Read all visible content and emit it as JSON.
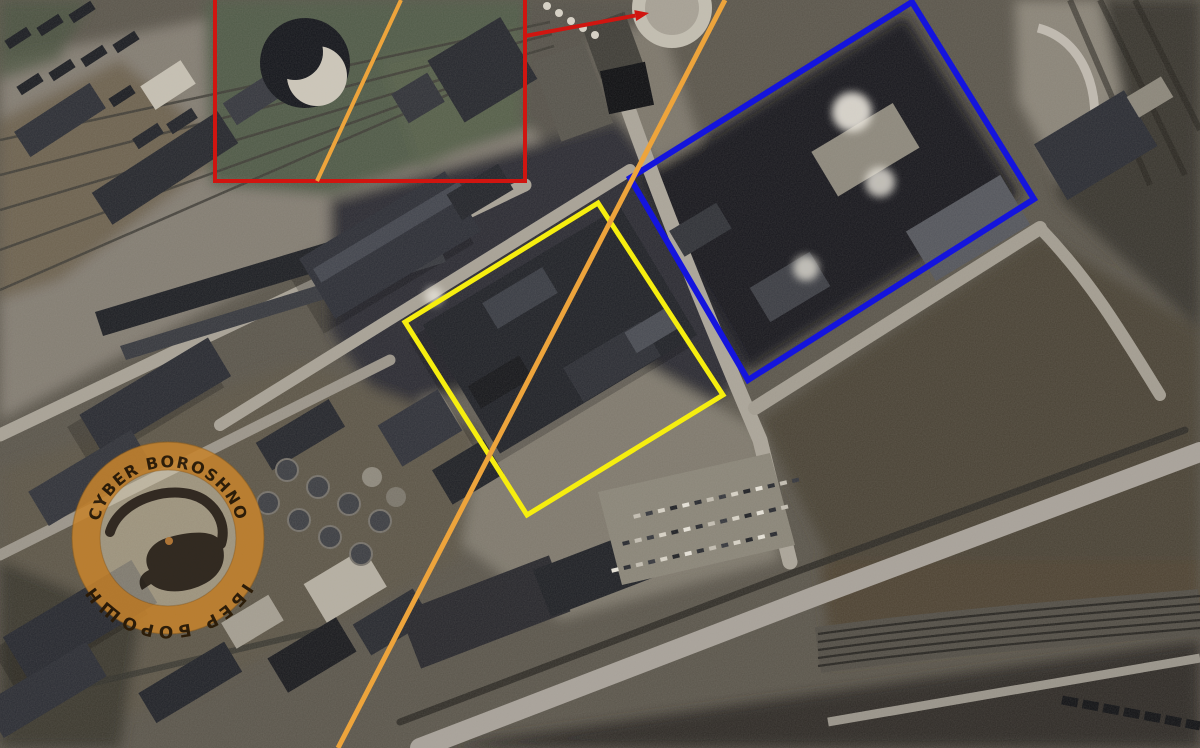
{
  "watermark": {
    "text_top": "· CYBER BOROSHNO ·",
    "text_bottom": "КІБЕР БОРОШНО",
    "ring_color": "#c5832e",
    "disc_color": "#e2d5b8",
    "text_color": "#2a1a06",
    "mole_color": "#201812",
    "accent_dot_color": "#b5722a",
    "center_x": 168,
    "center_y": 538,
    "outer_radius": 96,
    "inner_radius": 68
  },
  "annotations": {
    "red_box": {
      "color": "#d01510",
      "stroke_width": 4,
      "points": [
        [
          215,
          -30
        ],
        [
          525,
          -30
        ],
        [
          525,
          181
        ],
        [
          215,
          181
        ]
      ]
    },
    "red_arrow": {
      "color": "#d01510",
      "stroke_width": 4,
      "from": [
        525,
        36
      ],
      "to": [
        649,
        13
      ]
    },
    "yellow_box": {
      "color": "#f6ee0f",
      "stroke_width": 5,
      "points": [
        [
          598,
          203
        ],
        [
          723,
          395
        ],
        [
          527,
          515
        ],
        [
          405,
          322
        ]
      ]
    },
    "blue_box": {
      "color": "#1414dd",
      "stroke_width": 6,
      "points": [
        [
          912,
          2
        ],
        [
          1034,
          199
        ],
        [
          748,
          380
        ],
        [
          630,
          178
        ]
      ]
    },
    "orange_line_long": {
      "color": "#eda43c",
      "stroke_width": 5,
      "from": [
        725,
        0
      ],
      "to": [
        338,
        748
      ]
    },
    "orange_line_short": {
      "color": "#eda43c",
      "stroke_width": 4,
      "from": [
        401,
        0
      ],
      "to": [
        317,
        181
      ]
    }
  }
}
